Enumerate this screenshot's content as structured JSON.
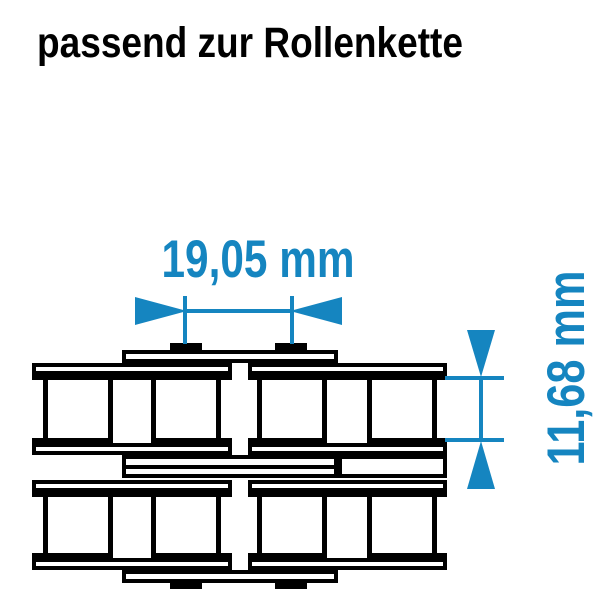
{
  "page": {
    "title": "passend zur Rollenkette"
  },
  "colors": {
    "accent": "#1585c0",
    "ink": "#000000",
    "background": "#ffffff"
  },
  "dimensions": {
    "pitch_label": "19,05 mm",
    "roller_label": "11,68 mm"
  }
}
